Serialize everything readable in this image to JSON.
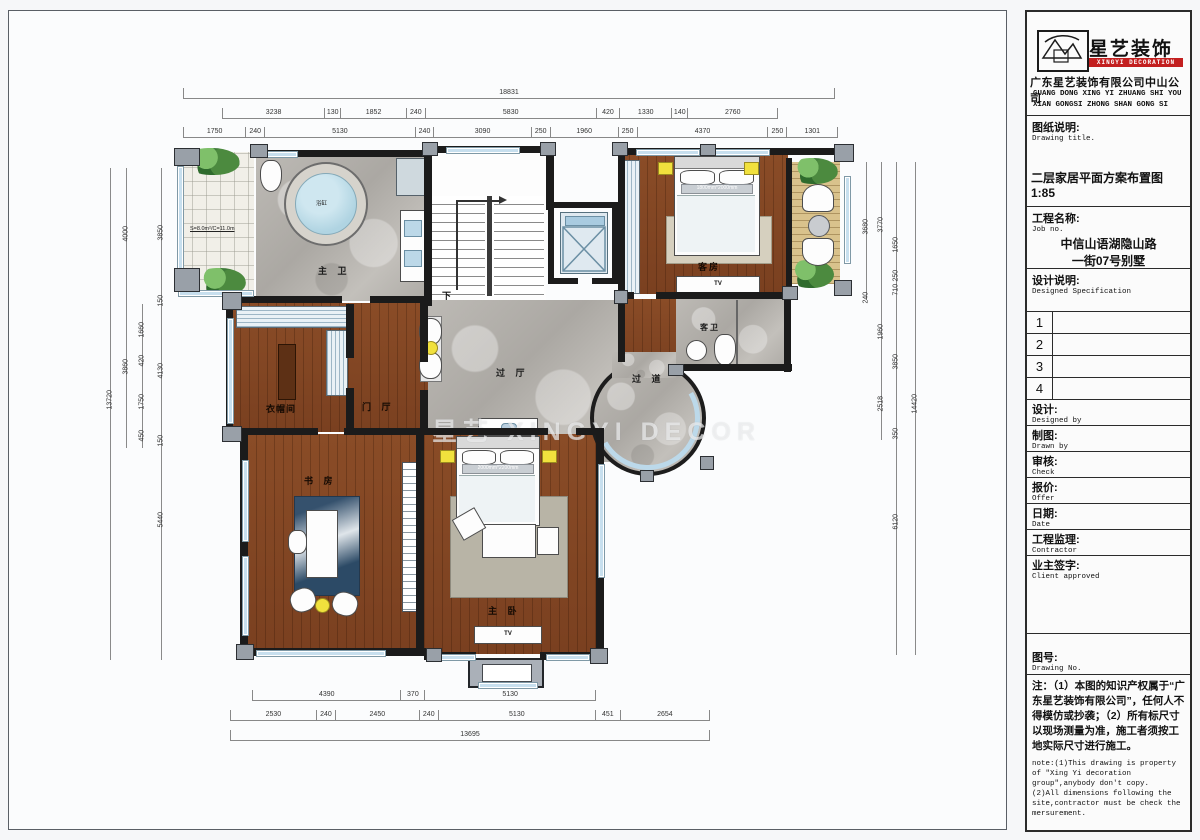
{
  "title_block": {
    "logo_text": "星艺装饰",
    "logo_band": "XINGYI DECORATION",
    "company_cn": "广东星艺装饰有限公司中山公司",
    "company_en1": "GUANG DONG XING YI ZHUANG SHI YOU",
    "company_en2": "XIAN GONGSI ZHONG SHAN GONG SI",
    "drawing_desc_cn": "图纸说明:",
    "drawing_desc_en": "Drawing title.",
    "sheet_title": "二层家居平面方案布置图 1:85",
    "job_cn": "工程名称:",
    "job_en": "Job  no.",
    "job_line1": "中信山语湖隐山路",
    "job_line2": "一街07号别墅",
    "spec_cn": "设计说明:",
    "spec_en": "Designed Specification",
    "spec_rows": [
      "1",
      "2",
      "3",
      "4"
    ],
    "fields": [
      {
        "cn": "设计:",
        "en": "Designed by"
      },
      {
        "cn": "制图:",
        "en": "Drawn by"
      },
      {
        "cn": "审核:",
        "en": "Check"
      },
      {
        "cn": "报价:",
        "en": "Offer"
      },
      {
        "cn": "日期:",
        "en": "Date"
      },
      {
        "cn": "工程监理:",
        "en": "Contractor"
      },
      {
        "cn": "业主签字:",
        "en": "Client approved"
      }
    ],
    "drawing_no_cn": "图号:",
    "drawing_no_en": "Drawing No.",
    "note_cn": "注：（1）本图的知识产权属于“广东星艺装饰有限公司”，任何人不得模仿或抄袭；（2）所有标尺寸以现场测量为准，施工者须按工地实际尺寸进行施工。",
    "note_en1": "note:(1)This drawing is property of \"Xing Yi decoration group\",anybody don't copy.",
    "note_en2": "(2)All dimensions following the site,contractor must be check the mersurement."
  },
  "rooms": {
    "master_bath": "主 卫",
    "closet": "衣帽间",
    "foyer": "门 厅",
    "study": "书 房",
    "master_bedroom": "主 卧",
    "hall": "过 厅",
    "corridor": "过 道",
    "guest_room": "客房",
    "guest_bath": "客卫",
    "stair_down": "下",
    "tub": "浴缸",
    "tv": "TV",
    "balcony_area": "S=8.0m²/C=11.0m",
    "master_bed_size": "2000mm*2200mm",
    "guest_bed_size": "1800mm*2000mm"
  },
  "watermark": "星艺 XINGYI DECOR",
  "dims": {
    "top_overall": [
      "18831"
    ],
    "top_row2": [
      "3238",
      "130",
      "1852",
      "240",
      "5830",
      "420",
      "1330",
      "140",
      "2760"
    ],
    "top_row3": [
      "1750",
      "240",
      "5130",
      "240",
      "3090",
      "250",
      "1960",
      "250",
      "4370",
      "250",
      "1301"
    ],
    "bottom_row1": [
      "4390",
      "370",
      "5130"
    ],
    "bottom_row2": [
      "2530",
      "240",
      "2450",
      "240",
      "5130",
      "451",
      "2654"
    ],
    "bottom_overall": [
      "13695"
    ],
    "left": [
      "13720",
      "4000",
      "3860",
      "1660",
      "420",
      "1750",
      "450",
      "3850",
      "150",
      "4130",
      "150",
      "5440"
    ],
    "right": [
      "3680",
      "240",
      "3770",
      "1960",
      "2518",
      "1650",
      "250",
      "710",
      "3850",
      "350",
      "6120",
      "14420"
    ]
  }
}
